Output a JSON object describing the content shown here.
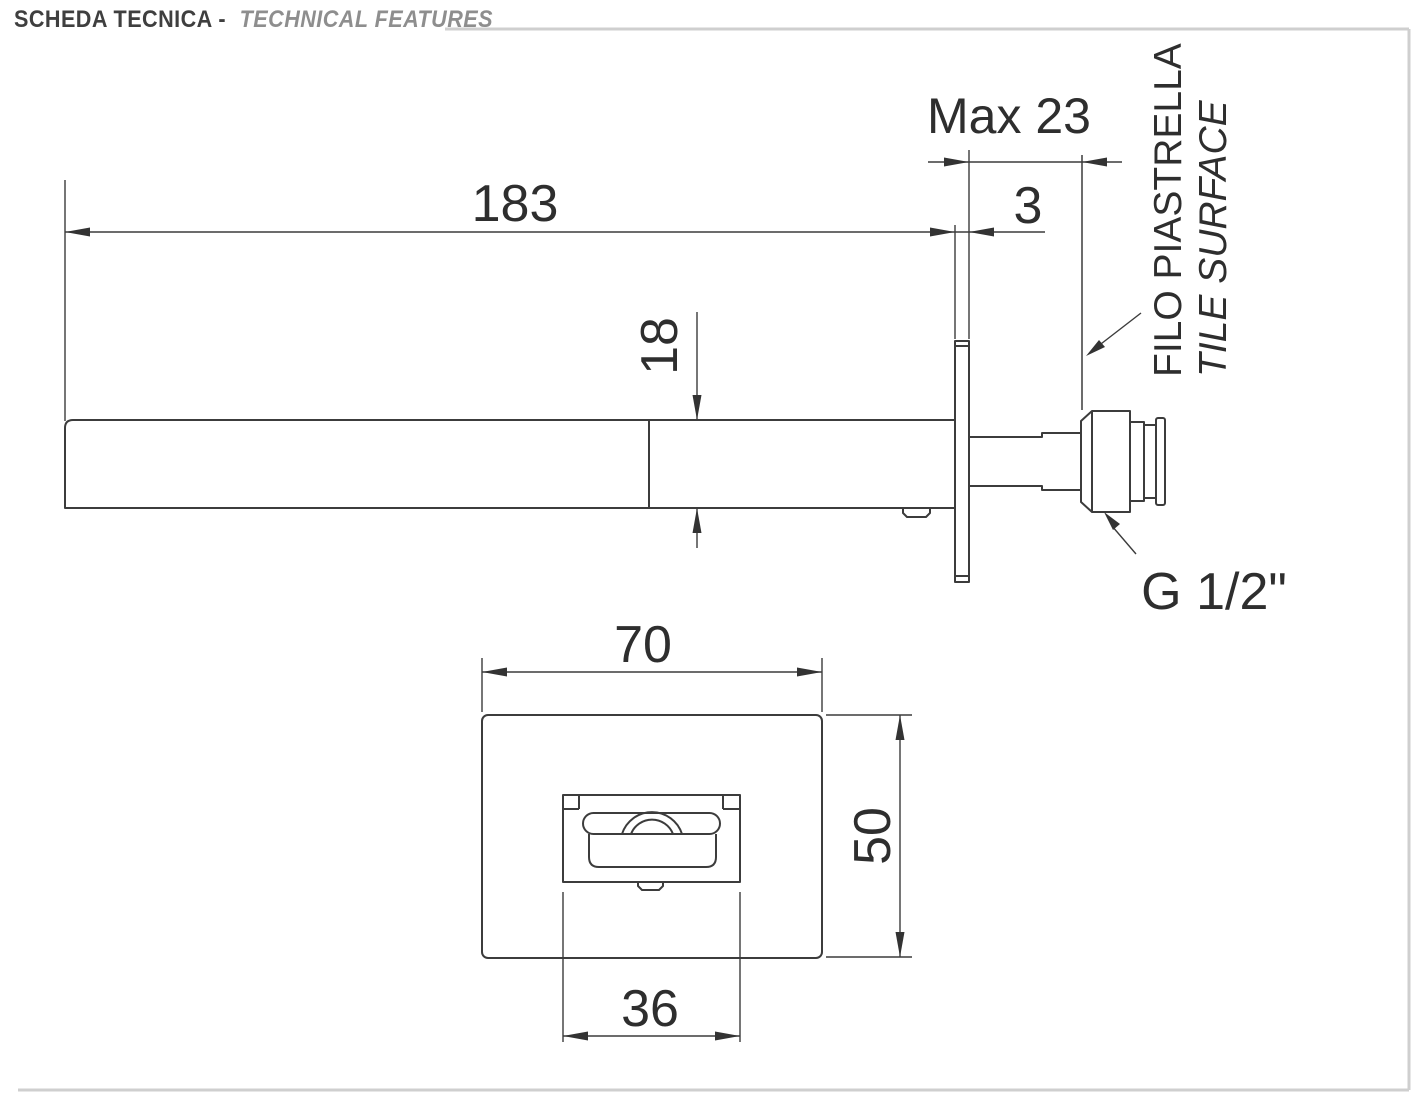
{
  "header": {
    "title_primary": "SCHEDA TECNICA -",
    "title_secondary": "TECHNICAL FEATURES"
  },
  "side_view": {
    "dim_spout_length": "183",
    "dim_wall_max": "Max 23",
    "dim_plate_thickness": "3",
    "dim_spout_height": "18",
    "tile_surface_label_it": "FILO PIASTRELLA",
    "tile_surface_label_en": "TILE SURFACE",
    "thread_label": "G 1/2\""
  },
  "front_view": {
    "dim_plate_width": "70",
    "dim_plate_height": "50",
    "dim_spout_width": "36"
  },
  "colors": {
    "drawing_line": "#3c3c3c",
    "dimension_text": "#2e2e2e",
    "rule_gray": "#cfcfcf",
    "title_primary": "#3f3f3f",
    "title_secondary": "#8e8e8e"
  }
}
